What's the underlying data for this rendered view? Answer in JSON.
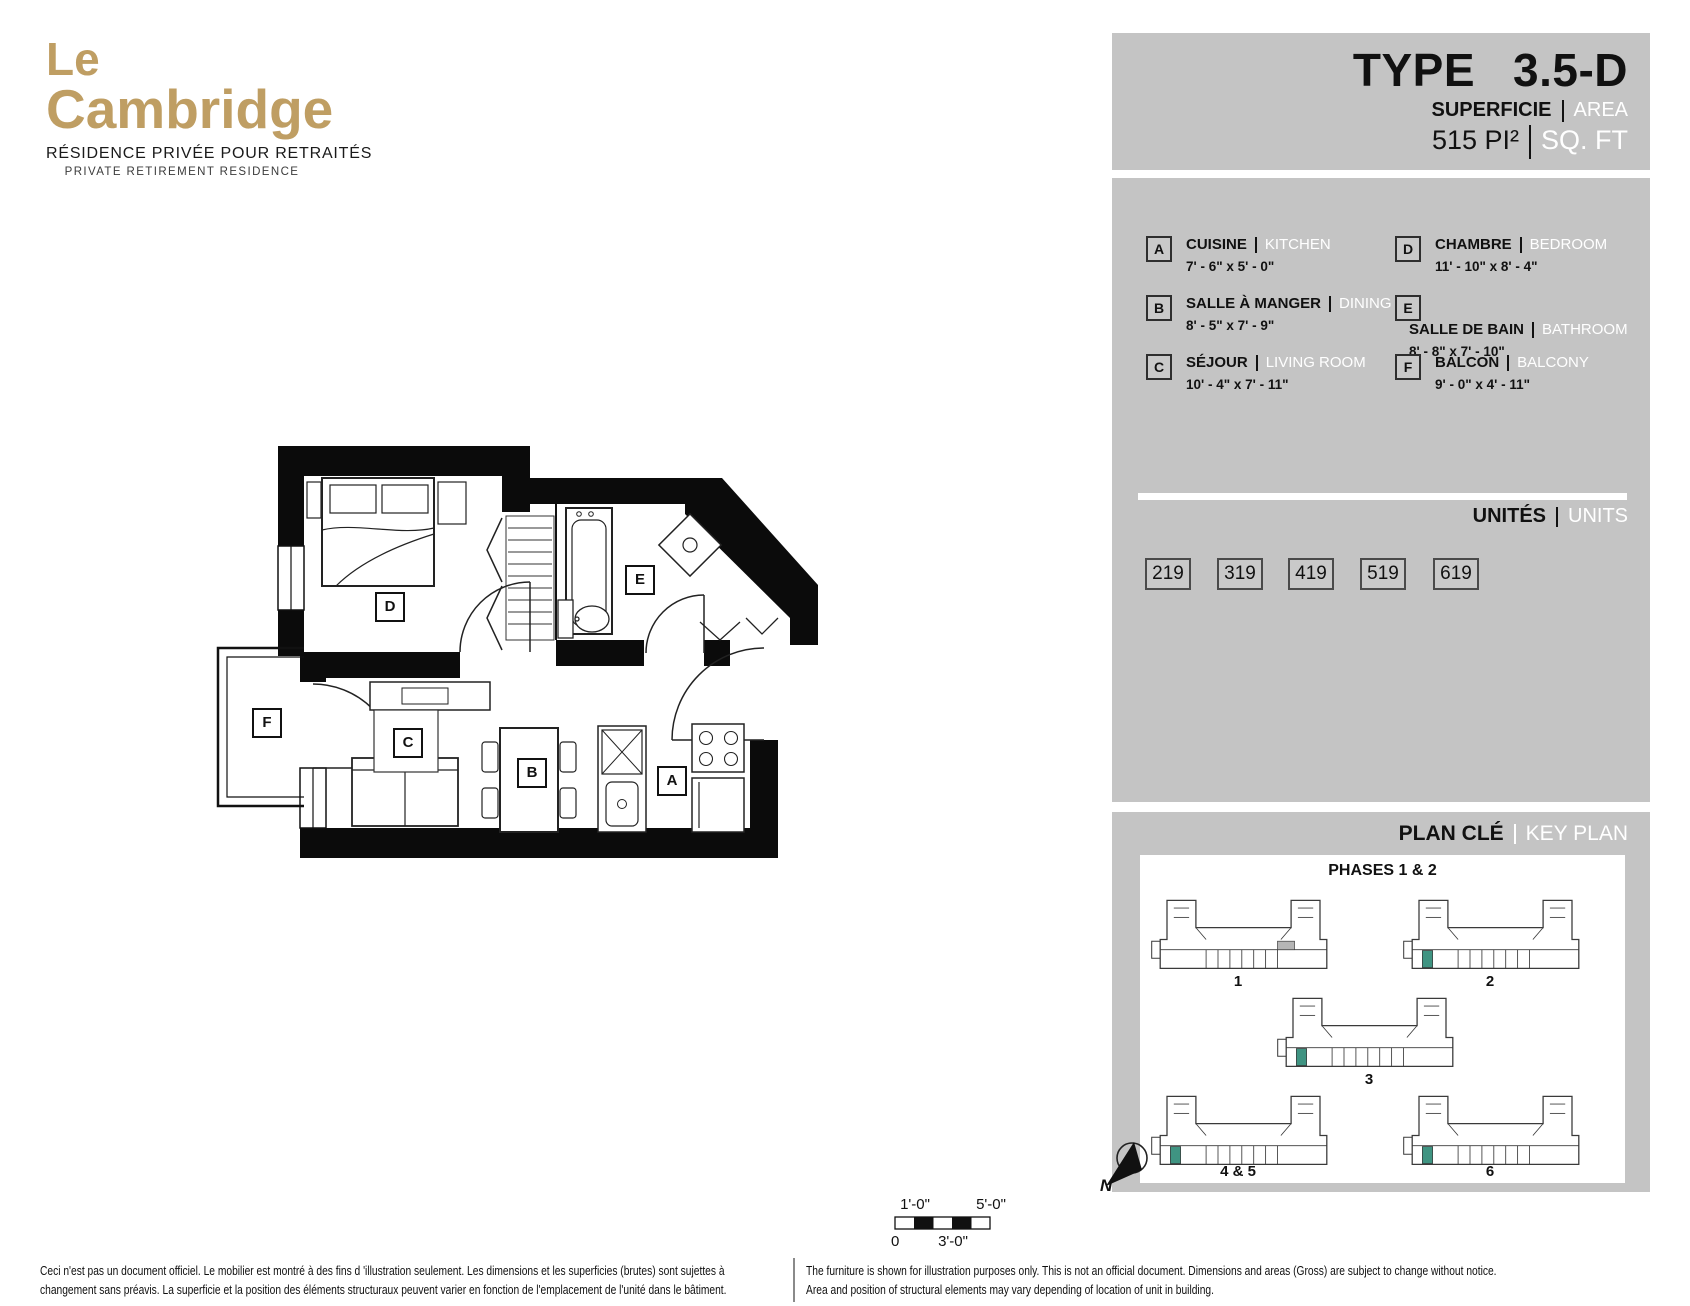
{
  "logo": {
    "line1": "Le",
    "line2": "Cambridge",
    "subtitle_fr": "RÉSIDENCE PRIVÉE POUR RETRAITÉS",
    "subtitle_en": "PRIVATE RETIREMENT RESIDENCE",
    "gold": "#bf9e63"
  },
  "header": {
    "type_label": "TYPE",
    "type_value": "3.5-D",
    "superficie": "SUPERFICIE",
    "area": "AREA",
    "size_value": "515 PI²",
    "size_unit": "SQ. FT"
  },
  "legend": {
    "items": [
      {
        "letter": "A",
        "fr": "CUISINE",
        "en": "KITCHEN",
        "dims": "7' - 6\" x 5' - 0\""
      },
      {
        "letter": "B",
        "fr": "SALLE À MANGER",
        "en": "DINING",
        "dims": "8' - 5\" x 7' - 9\""
      },
      {
        "letter": "C",
        "fr": "SÉJOUR",
        "en": "LIVING ROOM",
        "dims": "10' - 4\" x 7' - 11\""
      },
      {
        "letter": "D",
        "fr": "CHAMBRE",
        "en": "BEDROOM",
        "dims": "11' - 10\" x 8' - 4\""
      },
      {
        "letter": "E",
        "fr": "SALLE DE BAIN",
        "en": "BATHROOM",
        "dims": "8' - 8\" x 7' - 10\""
      },
      {
        "letter": "F",
        "fr": "BALCON",
        "en": "BALCONY",
        "dims": "9' - 0\" x 4' - 11\""
      }
    ]
  },
  "units": {
    "label_fr": "UNITÉS",
    "label_en": "UNITS",
    "numbers": [
      "219",
      "319",
      "419",
      "519",
      "619"
    ]
  },
  "keyplan": {
    "title_fr": "PLAN CLÉ",
    "title_en": "KEY PLAN",
    "phases_title": "PHASES 1 & 2",
    "buildings": [
      "1",
      "2",
      "3",
      "4 & 5",
      "6"
    ],
    "north_label": "N",
    "highlight_color": "#3f9482"
  },
  "floorplan": {
    "rooms": {
      "d": "D",
      "e": "E",
      "c": "C",
      "b": "B",
      "a": "A",
      "f": "F"
    },
    "scale": {
      "top_left": "1'-0\"",
      "top_right": "5'-0\"",
      "bottom_left": "0",
      "bottom_mid": "3'-0\""
    }
  },
  "footer": {
    "fr_line1": "Ceci n'est pas un document officiel.  Le mobilier est montré à des fins d 'illustration seulement.  Les dimensions et les superficies (brutes) sont sujettes à",
    "fr_line2": "changement sans préavis. La superficie et la position des éléments structuraux peuvent varier en fonction de l'emplacement de l'unité dans le bâtiment.",
    "en_line1": "The furniture is shown for illustration purposes only.  This is not an official document.  Dimensions and areas (Gross) are subject to change without notice.",
    "en_line2": "Area and position of structural elements may vary depending of location of unit in building."
  }
}
